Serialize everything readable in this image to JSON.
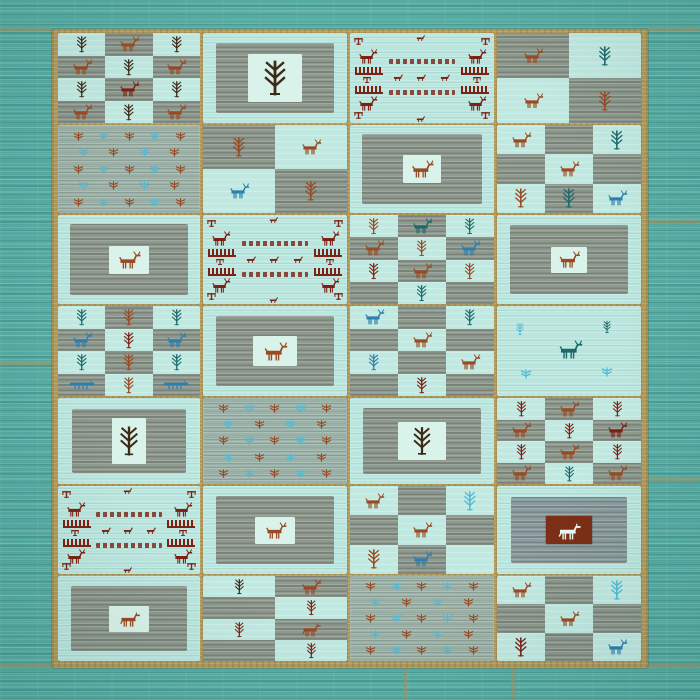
{
  "image": {
    "description": "Photograph of a teal patchwork Gabbeh wool rug composed of 28 woven panels in a 7-row by 4-column grid, separated by tan seams, decorated with tribal tree, deer, horse and pictograph motifs on striated turquoise and grey fields"
  },
  "palette": {
    "background": "#57aca3",
    "gold": "#b1995c",
    "seam": "#a8945f",
    "lightCell": "#bfe9e1",
    "darkCell": "#8e998f",
    "midField": "#9cb2a9",
    "whiteBox": "#d9f2ea",
    "blueField": "#8b9da0",
    "redBox": "#7b2f16",
    "darkbrown": "#3f2a18",
    "rust": "#9a4a22",
    "maroon": "#7c2114",
    "blue": "#2e7fae",
    "teal": "#1e6a6b",
    "skyblue": "#52b9d6",
    "whiteMotif": "#eaf7f1"
  },
  "canvas": {
    "w": 700,
    "h": 700
  },
  "background": {
    "seams": [
      {
        "x": 0,
        "y": 27,
        "w": 52,
        "h": 4
      },
      {
        "x": 648,
        "y": 27,
        "w": 52,
        "h": 4
      },
      {
        "x": 0,
        "y": 361,
        "w": 52,
        "h": 4
      },
      {
        "x": 648,
        "y": 220,
        "w": 52,
        "h": 4
      },
      {
        "x": 648,
        "y": 477,
        "w": 52,
        "h": 4
      },
      {
        "x": 0,
        "y": 664,
        "w": 700,
        "h": 4
      },
      {
        "x": 403,
        "y": 666,
        "w": 4,
        "h": 34
      },
      {
        "x": 511,
        "y": 666,
        "w": 4,
        "h": 34
      }
    ]
  },
  "rug": {
    "x": 52,
    "y": 29,
    "w": 596,
    "h": 639,
    "layout": {
      "colX": [
        6,
        151,
        298,
        445
      ],
      "colW": [
        142,
        144,
        144,
        144
      ],
      "rowY": [
        4,
        96,
        186,
        277,
        369,
        457,
        547
      ],
      "rowH": [
        90,
        88,
        89,
        90,
        86,
        88,
        85
      ]
    },
    "panels": [
      {
        "r": 0,
        "c": 0,
        "type": "checker",
        "grid": [
          3,
          4
        ],
        "first": "light",
        "cells": [
          "tree:darkbrown",
          "deer:rust",
          "tree:darkbrown",
          "deer:rust",
          "tree:darkbrown",
          "deer:rust",
          "tree:darkbrown",
          "deer:maroon",
          "tree:darkbrown",
          "deer:rust",
          "tree:darkbrown",
          "deer:rust"
        ]
      },
      {
        "r": 0,
        "c": 1,
        "type": "field",
        "inset": 13,
        "box": [
          54,
          48
        ],
        "motif": "tree:darkbrown",
        "msize": [
          24,
          40
        ]
      },
      {
        "r": 0,
        "c": 2,
        "type": "pictograph"
      },
      {
        "r": 0,
        "c": 3,
        "type": "checker",
        "grid": [
          2,
          2
        ],
        "first": "dark",
        "cells": [
          "deer:rust",
          "tree:teal",
          "deer:rust",
          "tree:rust"
        ]
      },
      {
        "r": 1,
        "c": 0,
        "type": "scatter",
        "bg": "midbg",
        "rows": 5
      },
      {
        "r": 1,
        "c": 1,
        "type": "checker",
        "grid": [
          2,
          2
        ],
        "first": "dark",
        "cells": [
          "tree:rust",
          "deer:rust",
          "deer:blue",
          "tree:rust"
        ]
      },
      {
        "r": 1,
        "c": 2,
        "type": "field",
        "inset": 12,
        "box": [
          38,
          28
        ],
        "motif": "deer:rust",
        "msize": [
          28,
          18
        ]
      },
      {
        "r": 1,
        "c": 3,
        "type": "checker",
        "grid": [
          3,
          3
        ],
        "first": "light",
        "cells": [
          "deer:rust",
          "",
          "tree:teal",
          "",
          "deer:rust",
          "",
          "tree:rust",
          "tree:teal",
          "deer:blue"
        ]
      },
      {
        "r": 2,
        "c": 0,
        "type": "field",
        "inset": 12,
        "box": [
          40,
          28
        ],
        "motif": "deer:rust",
        "msize": [
          28,
          18
        ]
      },
      {
        "r": 2,
        "c": 1,
        "type": "pictograph"
      },
      {
        "r": 2,
        "c": 2,
        "type": "checker",
        "grid": [
          3,
          4
        ],
        "first": "light",
        "cells": [
          "tree:rust",
          "deer:teal",
          "tree:teal",
          "deer:rust",
          "tree:rust",
          "deer:blue",
          "tree:maroon",
          "deer:rust",
          "tree:rust",
          "",
          "tree:teal",
          ""
        ]
      },
      {
        "r": 2,
        "c": 3,
        "type": "field",
        "inset": 13,
        "box": [
          36,
          26
        ],
        "motif": "deer:rust",
        "msize": [
          26,
          17
        ]
      },
      {
        "r": 3,
        "c": 0,
        "type": "checker",
        "grid": [
          3,
          4
        ],
        "first": "light",
        "cells": [
          "tree:teal",
          "tree:rust",
          "tree:teal",
          "deer:blue",
          "tree:maroon",
          "deer:blue",
          "tree:teal",
          "tree:rust",
          "tree:teal",
          "caravan:blue",
          "tree:rust",
          "caravan:blue"
        ]
      },
      {
        "r": 3,
        "c": 1,
        "type": "field",
        "inset": 13,
        "box": [
          44,
          30
        ],
        "motif": "deer:rust",
        "msize": [
          30,
          19
        ]
      },
      {
        "r": 3,
        "c": 2,
        "type": "checker",
        "grid": [
          3,
          4
        ],
        "first": "light",
        "cells": [
          "deer:blue",
          "",
          "tree:teal",
          "",
          "deer:rust",
          "",
          "tree:blue",
          "",
          "deer:rust",
          "",
          "tree:maroon",
          ""
        ]
      },
      {
        "r": 3,
        "c": 3,
        "type": "scatterplain",
        "bg": "lightbg",
        "items": [
          {
            "m": "tree:skyblue",
            "x": "12%",
            "y": "18%"
          },
          {
            "m": "tree:teal",
            "x": "72%",
            "y": "16%"
          },
          {
            "m": "deer:teal",
            "x": "40%",
            "y": "38%",
            "s": [
              30,
              19
            ]
          },
          {
            "m": "bird:skyblue",
            "x": "16%",
            "y": "68%"
          },
          {
            "m": "bird:skyblue",
            "x": "72%",
            "y": "66%"
          }
        ]
      },
      {
        "r": 4,
        "c": 0,
        "type": "field",
        "inset": 14,
        "box": [
          34,
          46
        ],
        "motif": "tree:darkbrown",
        "msize": [
          20,
          38
        ]
      },
      {
        "r": 4,
        "c": 1,
        "type": "scatter",
        "bg": "midbg",
        "rows": 5
      },
      {
        "r": 4,
        "c": 2,
        "type": "field",
        "inset": 13,
        "box": [
          48,
          38
        ],
        "motif": "tree:darkbrown",
        "msize": [
          20,
          32
        ]
      },
      {
        "r": 4,
        "c": 3,
        "type": "checker",
        "grid": [
          3,
          4
        ],
        "first": "light",
        "cells": [
          "tree:maroon",
          "deer:rust",
          "tree:maroon",
          "deer:rust",
          "tree:maroon",
          "deer:maroon",
          "tree:maroon",
          "deer:rust",
          "tree:maroon",
          "deer:rust",
          "tree:teal",
          "deer:rust"
        ]
      },
      {
        "r": 5,
        "c": 0,
        "type": "pictograph"
      },
      {
        "r": 5,
        "c": 1,
        "type": "field",
        "inset": 13,
        "box": [
          40,
          27
        ],
        "motif": "deer:rust",
        "msize": [
          27,
          17
        ]
      },
      {
        "r": 5,
        "c": 2,
        "type": "checker",
        "grid": [
          3,
          3
        ],
        "first": "light",
        "cells": [
          "deer:rust",
          "",
          "tree:skyblue",
          "",
          "deer:rust",
          "",
          "tree:rust",
          "deer:blue",
          ""
        ]
      },
      {
        "r": 5,
        "c": 3,
        "type": "redbox",
        "inset": 14,
        "box": [
          46,
          28
        ],
        "motif": "horse:whiteMotif",
        "msize": [
          30,
          19
        ]
      },
      {
        "r": 6,
        "c": 0,
        "type": "field",
        "inset": 13,
        "box": [
          40,
          26
        ],
        "motif": "horse:rust",
        "msize": [
          27,
          17
        ]
      },
      {
        "r": 6,
        "c": 1,
        "type": "checker",
        "grid": [
          2,
          4
        ],
        "first": "light",
        "cells": [
          "tree:darkbrown",
          "deer:rust",
          "",
          "tree:maroon",
          "tree:maroon",
          "horse:rust",
          "",
          "tree:maroon"
        ]
      },
      {
        "r": 6,
        "c": 2,
        "type": "scatter",
        "bg": "midbg",
        "rows": 5
      },
      {
        "r": 6,
        "c": 3,
        "type": "checker",
        "grid": [
          3,
          3
        ],
        "first": "light",
        "cells": [
          "deer:rust",
          "",
          "tree:skyblue",
          "",
          "deer:rust",
          "",
          "tree:maroon",
          "",
          "deer:blue"
        ]
      }
    ]
  }
}
